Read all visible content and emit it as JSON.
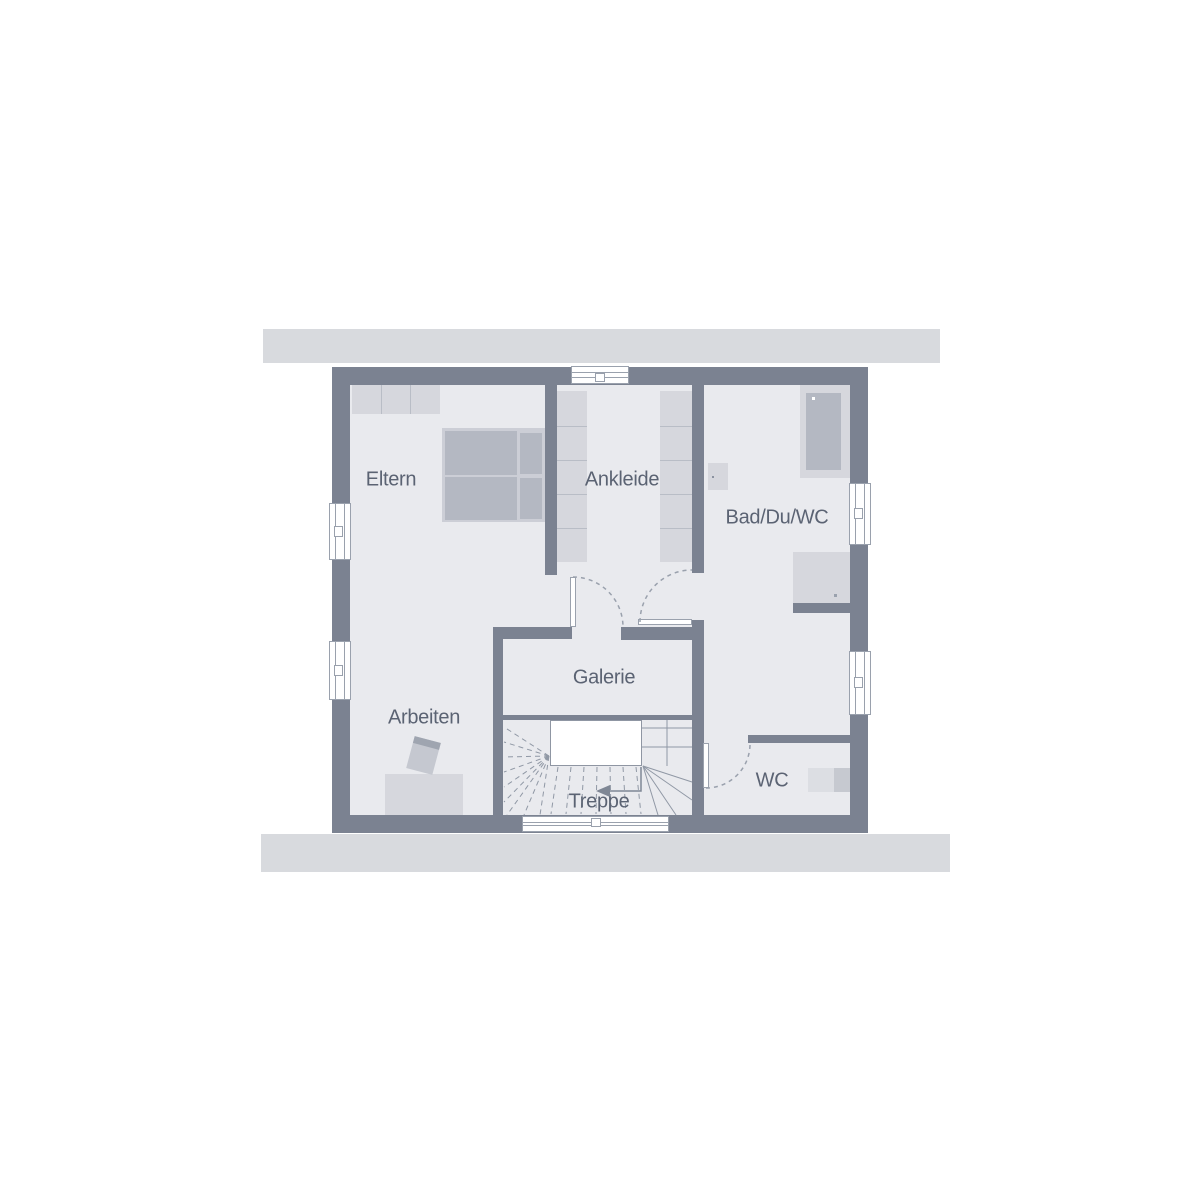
{
  "floorplan": {
    "rooms": [
      {
        "id": "eltern",
        "label": "Eltern"
      },
      {
        "id": "ankleide",
        "label": "Ankleide"
      },
      {
        "id": "bad-du-wc",
        "label": "Bad/Du/WC"
      },
      {
        "id": "arbeiten",
        "label": "Arbeiten"
      },
      {
        "id": "galerie",
        "label": "Galerie"
      },
      {
        "id": "treppe",
        "label": "Treppe"
      },
      {
        "id": "wc",
        "label": "WC"
      }
    ],
    "stair_arrow_direction": "left",
    "colors": {
      "wall": "#7b8291",
      "floor": "#e9eaee",
      "roof_strip": "#d8dade",
      "furniture_light": "#d6d7dd",
      "furniture_medium": "#b4b8c2",
      "symbol_line": "#9aa1ad",
      "label_text": "#5b6373",
      "background": "#ffffff"
    }
  }
}
